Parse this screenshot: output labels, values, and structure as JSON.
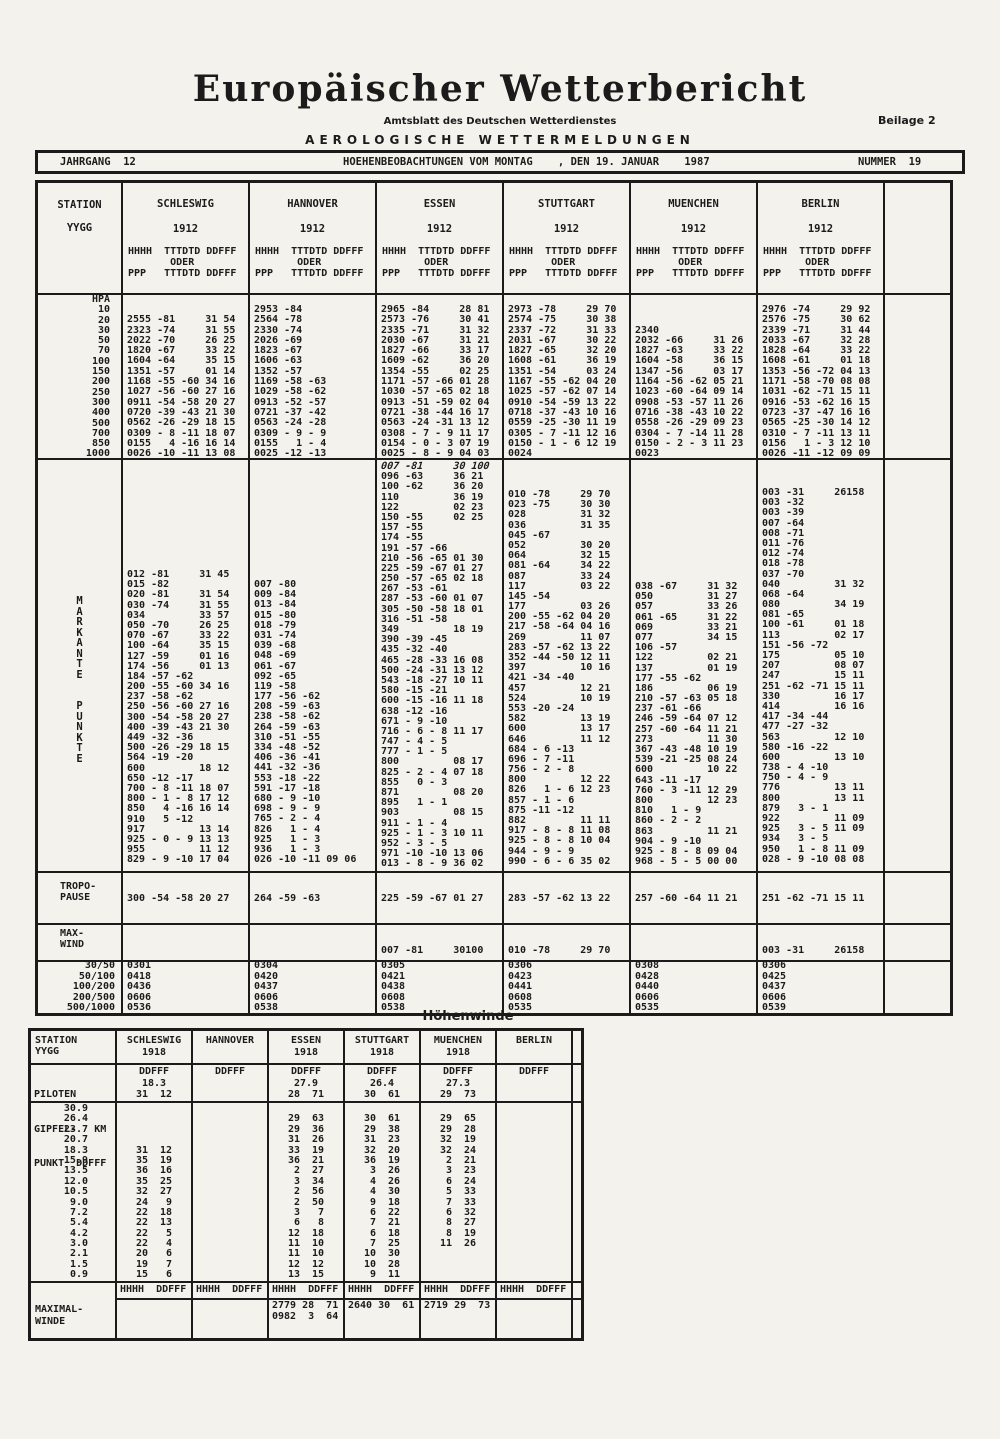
{
  "page": {
    "title": "Europäischer Wetterbericht",
    "subtitle": "Amtsblatt des Deutschen Wetterdienstes",
    "supplement": "Beilage 2",
    "section_title": "AEROLOGISCHE WETTERMELDUNGEN",
    "jahrgang": "JAHRGANG  12",
    "observation_header": "HOEHENBEOBACHTUNGEN VOM MONTAG    , DEN 19. JANUAR    1987",
    "nummer": "NUMMER  19"
  },
  "main_table": {
    "station_label": "STATION",
    "yygg_label": "YYGG",
    "col_header": [
      "HHHH  TTTDTD DDFFF",
      "       ODER",
      "PPP   TTTDTD DDFFF"
    ],
    "hpa_label": "HPA",
    "hpa_levels": [
      "10",
      "20",
      "30",
      "50",
      "70",
      "100",
      "150",
      "200",
      "250",
      "300",
      "400",
      "500",
      "700",
      "850",
      "1000"
    ],
    "markante_label_1": "MARKANTE",
    "markante_label_2": "PUNKTE",
    "tropo_label": [
      "TROPO-",
      "PAUSE"
    ],
    "maxwind_label": [
      "MAX-",
      "WIND"
    ],
    "shear_labels": [
      "30/50",
      "50/100",
      "100/200",
      "200/500",
      "500/1000"
    ],
    "stations": [
      {
        "name": "SCHLESWIG",
        "yygg": "1912",
        "hpa": [
          "",
          "2555 -81     31 54",
          "2323 -74     31 55",
          "2022 -70     26 25",
          "1820 -67     33 22",
          "1604 -64     35 15",
          "1351 -57     01 14",
          "1168 -55 -60 34 16",
          "1027 -56 -60 27 16",
          "0911 -54 -58 20 27",
          "0720 -39 -43 21 30",
          "0562 -26 -29 18 15",
          "0309 - 8 -11 18 07",
          "0155   4 -16 16 14",
          "0026 -10 -11 13 08"
        ],
        "markante": [
          "012 -81     31 45",
          "015 -82",
          "020 -81     31 54",
          "030 -74     31 55",
          "034         33 57",
          "050 -70     26 25",
          "070 -67     33 22",
          "100 -64     35 15",
          "127 -59     01 16",
          "174 -56     01 13",
          "184 -57 -62",
          "200 -55 -60 34 16",
          "237 -58 -62",
          "250 -56 -60 27 16",
          "300 -54 -58 20 27",
          "400 -39 -43 21 30",
          "449 -32 -36",
          "500 -26 -29 18 15",
          "564 -19 -20",
          "600         18 12",
          "650 -12 -17",
          "700 - 8 -11 18 07",
          "800 - 1 - 8 17 12",
          "850   4 -16 16 14",
          "910   5 -12",
          "917         13 14",
          "925 - 0 - 9 13 13",
          "955         11 12",
          "829 - 9 -10 17 04"
        ],
        "tropopause": "300 -54 -58 20 27",
        "maxwind": "",
        "shear": [
          "0301",
          "0418",
          "0436",
          "0606",
          "0536"
        ]
      },
      {
        "name": "HANNOVER",
        "yygg": "1912",
        "hpa": [
          "2953 -84",
          "2564 -78",
          "2330 -74",
          "2026 -69",
          "1823 -67",
          "1606 -63",
          "1352 -57",
          "1169 -58 -63",
          "1029 -58 -62",
          "0913 -52 -57",
          "0721 -37 -42",
          "0563 -24 -28",
          "0309 - 9 - 9",
          "0155   1 - 4",
          "0025 -12 -13"
        ],
        "markante": [
          "007 -80",
          "009 -84",
          "013 -84",
          "015 -80",
          "018 -79",
          "031 -74",
          "039 -68",
          "048 -69",
          "061 -67",
          "092 -65",
          "119 -58",
          "177 -56 -62",
          "208 -59 -63",
          "238 -58 -62",
          "264 -59 -63",
          "310 -51 -55",
          "334 -48 -52",
          "406 -36 -41",
          "441 -32 -36",
          "553 -18 -22",
          "591 -17 -18",
          "680 - 9 -10",
          "698 - 9 - 9",
          "765 - 2 - 4",
          "826   1 - 4",
          "925   1 - 3",
          "936   1 - 3",
          "026 -10 -11 09 06"
        ],
        "tropopause": "264 -59 -63",
        "maxwind": "",
        "shear": [
          "0304",
          "0420",
          "0437",
          "0606",
          "0538"
        ]
      },
      {
        "name": "ESSEN",
        "yygg": "1912",
        "hpa": [
          "2965 -84     28 81",
          "2573 -76     30 41",
          "2335 -71     31 32",
          "2030 -67     31 21",
          "1827 -66     33 17",
          "1609 -62     36 20",
          "1354 -55     02 25",
          "1171 -57 -66 01 28",
          "1030 -57 -65 02 18",
          "0913 -51 -59 02 04",
          "0721 -38 -44 16 17",
          "0563 -24 -31 13 12",
          "0308 - 7 - 9 11 17",
          "0154 - 0 - 3 07 19",
          "0025 - 8 - 9 04 03"
        ],
        "markante": [
          "007 -81     30 100",
          "096 -63     36 21",
          "100 -62     36 20",
          "110         36 19",
          "122         02 23",
          "150 -55     02 25",
          "157 -55",
          "174 -55",
          "191 -57 -66",
          "210 -56 -65 01 30",
          "225 -59 -67 01 27",
          "250 -57 -65 02 18",
          "267 -53 -61",
          "287 -53 -60 01 07",
          "305 -50 -58 18 01",
          "316 -51 -58",
          "349         18 19",
          "390 -39 -45",
          "435 -32 -40",
          "465 -28 -33 16 08",
          "500 -24 -31 13 12",
          "543 -18 -27 10 11",
          "580 -15 -21",
          "600 -15 -16 11 18",
          "638 -12 -16",
          "671 - 9 -10",
          "716 - 6 - 8 11 17",
          "747 - 4 - 5",
          "777 - 1 - 5",
          "800         08 17",
          "825 - 2 - 4 07 18",
          "855   0 - 3",
          "871         08 20",
          "895   1 - 1",
          "903         08 15",
          "911 - 1 - 4",
          "925 - 1 - 3 10 11",
          "952 - 3 - 5",
          "971 -10 -10 13 06",
          "013 - 8 - 9 36 02"
        ],
        "tropopause": "225 -59 -67 01 27",
        "maxwind": "007 -81     30100",
        "shear": [
          "0305",
          "0421",
          "0438",
          "0608",
          "0538"
        ]
      },
      {
        "name": "STUTTGART",
        "yygg": "1912",
        "hpa": [
          "2973 -78     29 70",
          "2574 -75     30 38",
          "2337 -72     31 33",
          "2031 -67     30 22",
          "1827 -65     32 20",
          "1608 -61     36 19",
          "1351 -54     03 24",
          "1167 -55 -62 04 20",
          "1025 -57 -62 07 14",
          "0910 -54 -59 13 22",
          "0718 -37 -43 10 16",
          "0559 -25 -30 11 19",
          "0305 - 7 -11 12 16",
          "0150 - 1 - 6 12 19",
          "0024"
        ],
        "markante": [
          "010 -78     29 70",
          "023 -75     30 30",
          "028         31 32",
          "036         31 35",
          "045 -67",
          "052         30 20",
          "064         32 15",
          "081 -64     34 22",
          "087         33 24",
          "117         03 22",
          "145 -54",
          "177         03 26",
          "200 -55 -62 04 20",
          "217 -58 -64 04 16",
          "269         11 07",
          "283 -57 -62 13 22",
          "352 -44 -50 12 11",
          "397         10 16",
          "421 -34 -40",
          "457         12 21",
          "524         10 19",
          "553 -20 -24",
          "582         13 19",
          "600         13 17",
          "646         11 12",
          "684 - 6 -13",
          "696 - 7 -11",
          "756 - 2 - 8",
          "800         12 22",
          "826   1 - 6 12 23",
          "857 - 1 - 6",
          "875 -11 -12",
          "882         11 11",
          "917 - 8 - 8 11 08",
          "925 - 8 - 8 10 04",
          "944 - 9 - 9",
          "990 - 6 - 6 35 02"
        ],
        "tropopause": "283 -57 -62 13 22",
        "maxwind": "010 -78     29 70",
        "shear": [
          "0306",
          "0423",
          "0441",
          "0608",
          "0535"
        ]
      },
      {
        "name": "MUENCHEN",
        "yygg": "1912",
        "hpa": [
          "",
          "",
          "2340",
          "2032 -66     31 26",
          "1827 -63     33 22",
          "1604 -58     36 15",
          "1347 -56     03 17",
          "1164 -56 -62 05 21",
          "1023 -60 -64 09 14",
          "0908 -53 -57 11 26",
          "0716 -38 -43 10 22",
          "0558 -26 -29 09 23",
          "0304 - 7 -14 11 28",
          "0150 - 2 - 3 11 23",
          "0023"
        ],
        "markante": [
          "038 -67     31 32",
          "050         31 27",
          "057         33 26",
          "061 -65     31 22",
          "069         33 21",
          "077         34 15",
          "106 -57",
          "122         02 21",
          "137         01 19",
          "177 -55 -62",
          "186         06 19",
          "210 -57 -63 05 18",
          "237 -61 -66",
          "246 -59 -64 07 12",
          "257 -60 -64 11 21",
          "273         11 30",
          "367 -43 -48 10 19",
          "539 -21 -25 08 24",
          "600         10 22",
          "643 -11 -17",
          "760 - 3 -11 12 29",
          "800         12 23",
          "810   1 - 9",
          "860 - 2 - 2",
          "863         11 21",
          "904 - 9 -10",
          "925 - 8 - 8 09 04",
          "968 - 5 - 5 00 00"
        ],
        "tropopause": "257 -60 -64 11 21",
        "maxwind": "",
        "shear": [
          "0308",
          "0428",
          "0440",
          "0606",
          "0535"
        ]
      },
      {
        "name": "BERLIN",
        "yygg": "1912",
        "hpa": [
          "2976 -74     29 92",
          "2576 -75     30 62",
          "2339 -71     31 44",
          "2033 -67     32 28",
          "1828 -64     33 22",
          "1608 -61     01 18",
          "1353 -56 -72 04 13",
          "1171 -58 -70 08 08",
          "1031 -62 -71 15 11",
          "0916 -53 -62 16 15",
          "0723 -37 -47 16 16",
          "0565 -25 -30 14 12",
          "0310 - 7 -11 13 11",
          "0156   1 - 3 12 10",
          "0026 -11 -12 09 09"
        ],
        "markante": [
          "003 -31     26158",
          "003 -32",
          "003 -39",
          "007 -64",
          "008 -71",
          "011 -76",
          "012 -74",
          "018 -78",
          "037 -70",
          "040         31 32",
          "068 -64",
          "080         34 19",
          "081 -65",
          "100 -61     01 18",
          "113         02 17",
          "151 -56 -72",
          "175         05 10",
          "207         08 07",
          "247         15 11",
          "251 -62 -71 15 11",
          "330         16 17",
          "414         16 16",
          "417 -34 -44",
          "477 -27 -32",
          "563         12 10",
          "580 -16 -22",
          "600         13 10",
          "738 - 4 -10",
          "750 - 4 - 9",
          "776         13 11",
          "800         13 11",
          "879   3 - 1",
          "922         11 09",
          "925   3 - 5 11 09",
          "934   3 - 5",
          "950   1 - 8 11 09",
          "028 - 9 -10 08 08"
        ],
        "tropopause": "251 -62 -71 15 11",
        "maxwind": "003 -31     26158",
        "shear": [
          "0306",
          "0425",
          "0437",
          "0606",
          "0539"
        ]
      }
    ]
  },
  "hoehenwinde": {
    "title": "Höhenwinde",
    "station_label": "STATION",
    "yygg_label": "YYGG",
    "piloten_label": [
      "PILOTEN",
      "GIPFEL-   KM",
      "PUNKT  DDFFF"
    ],
    "heights": [
      "30.9",
      "26.4",
      "23.7",
      "20.7",
      "18.3",
      "15.9",
      "13.5",
      "12.0",
      "10.5",
      "9.0",
      "7.2",
      "5.4",
      "4.2",
      "3.0",
      "2.1",
      "1.5",
      "0.9"
    ],
    "maximal_label": [
      "MAXIMAL-",
      "WINDE"
    ],
    "maximal_header": "HHHH  DDFFF",
    "stations": [
      {
        "name": "SCHLESWIG",
        "yygg": "1918",
        "ddfff_label": "DDFFF",
        "gipfel_km": "18.3",
        "gipfel_wind": "31  12",
        "winds": [
          "",
          "",
          "",
          "",
          "31  12",
          "35  19",
          "36  16",
          "35  25",
          "32  27",
          "24   9",
          "22  18",
          "22  13",
          "22   5",
          "22   4",
          "20   6",
          "19   7",
          "15   6"
        ],
        "maximal": []
      },
      {
        "name": "HANNOVER",
        "yygg": "",
        "ddfff_label": "DDFFF",
        "gipfel_km": "",
        "gipfel_wind": "",
        "winds": [
          "",
          "",
          "",
          "",
          "",
          "",
          "",
          "",
          "",
          "",
          "",
          "",
          "",
          "",
          "",
          "",
          ""
        ],
        "maximal": []
      },
      {
        "name": "ESSEN",
        "yygg": "1918",
        "ddfff_label": "DDFFF",
        "gipfel_km": "27.9",
        "gipfel_wind": "28  71",
        "winds": [
          "",
          "29  63",
          "29  36",
          "31  26",
          "33  19",
          "36  21",
          " 2  27",
          " 3  34",
          " 2  56",
          " 2  50",
          " 3   7",
          " 6   8",
          "12  18",
          "11  10",
          "11  10",
          "12  12",
          "13  15"
        ],
        "maximal": [
          "2779 28  71",
          "0982  3  64"
        ]
      },
      {
        "name": "STUTTGART",
        "yygg": "1918",
        "ddfff_label": "DDFFF",
        "gipfel_km": "26.4",
        "gipfel_wind": "30  61",
        "winds": [
          "",
          "30  61",
          "29  38",
          "31  23",
          "32  20",
          "36  19",
          " 3  26",
          " 4  26",
          " 4  30",
          " 9  18",
          " 6  22",
          " 7  21",
          " 6  18",
          " 7  25",
          "10  30",
          "10  28",
          " 9  11"
        ],
        "maximal": [
          "",
          "2640 30  61"
        ]
      },
      {
        "name": "MUENCHEN",
        "yygg": "1918",
        "ddfff_label": "DDFFF",
        "gipfel_km": "27.3",
        "gipfel_wind": "29  73",
        "winds": [
          "",
          "29  65",
          "29  28",
          "32  19",
          "32  24",
          " 2  21",
          " 3  23",
          " 6  24",
          " 5  33",
          " 7  33",
          " 6  32",
          " 8  27",
          " 8  19",
          "11  26",
          "",
          "",
          ""
        ],
        "maximal": [
          "",
          "2719 29  73"
        ]
      },
      {
        "name": "BERLIN",
        "yygg": "",
        "ddfff_label": "DDFFF",
        "gipfel_km": "",
        "gipfel_wind": "",
        "winds": [
          "",
          "",
          "",
          "",
          "",
          "",
          "",
          "",
          "",
          "",
          "",
          "",
          "",
          "",
          "",
          "",
          ""
        ],
        "maximal": []
      }
    ]
  }
}
